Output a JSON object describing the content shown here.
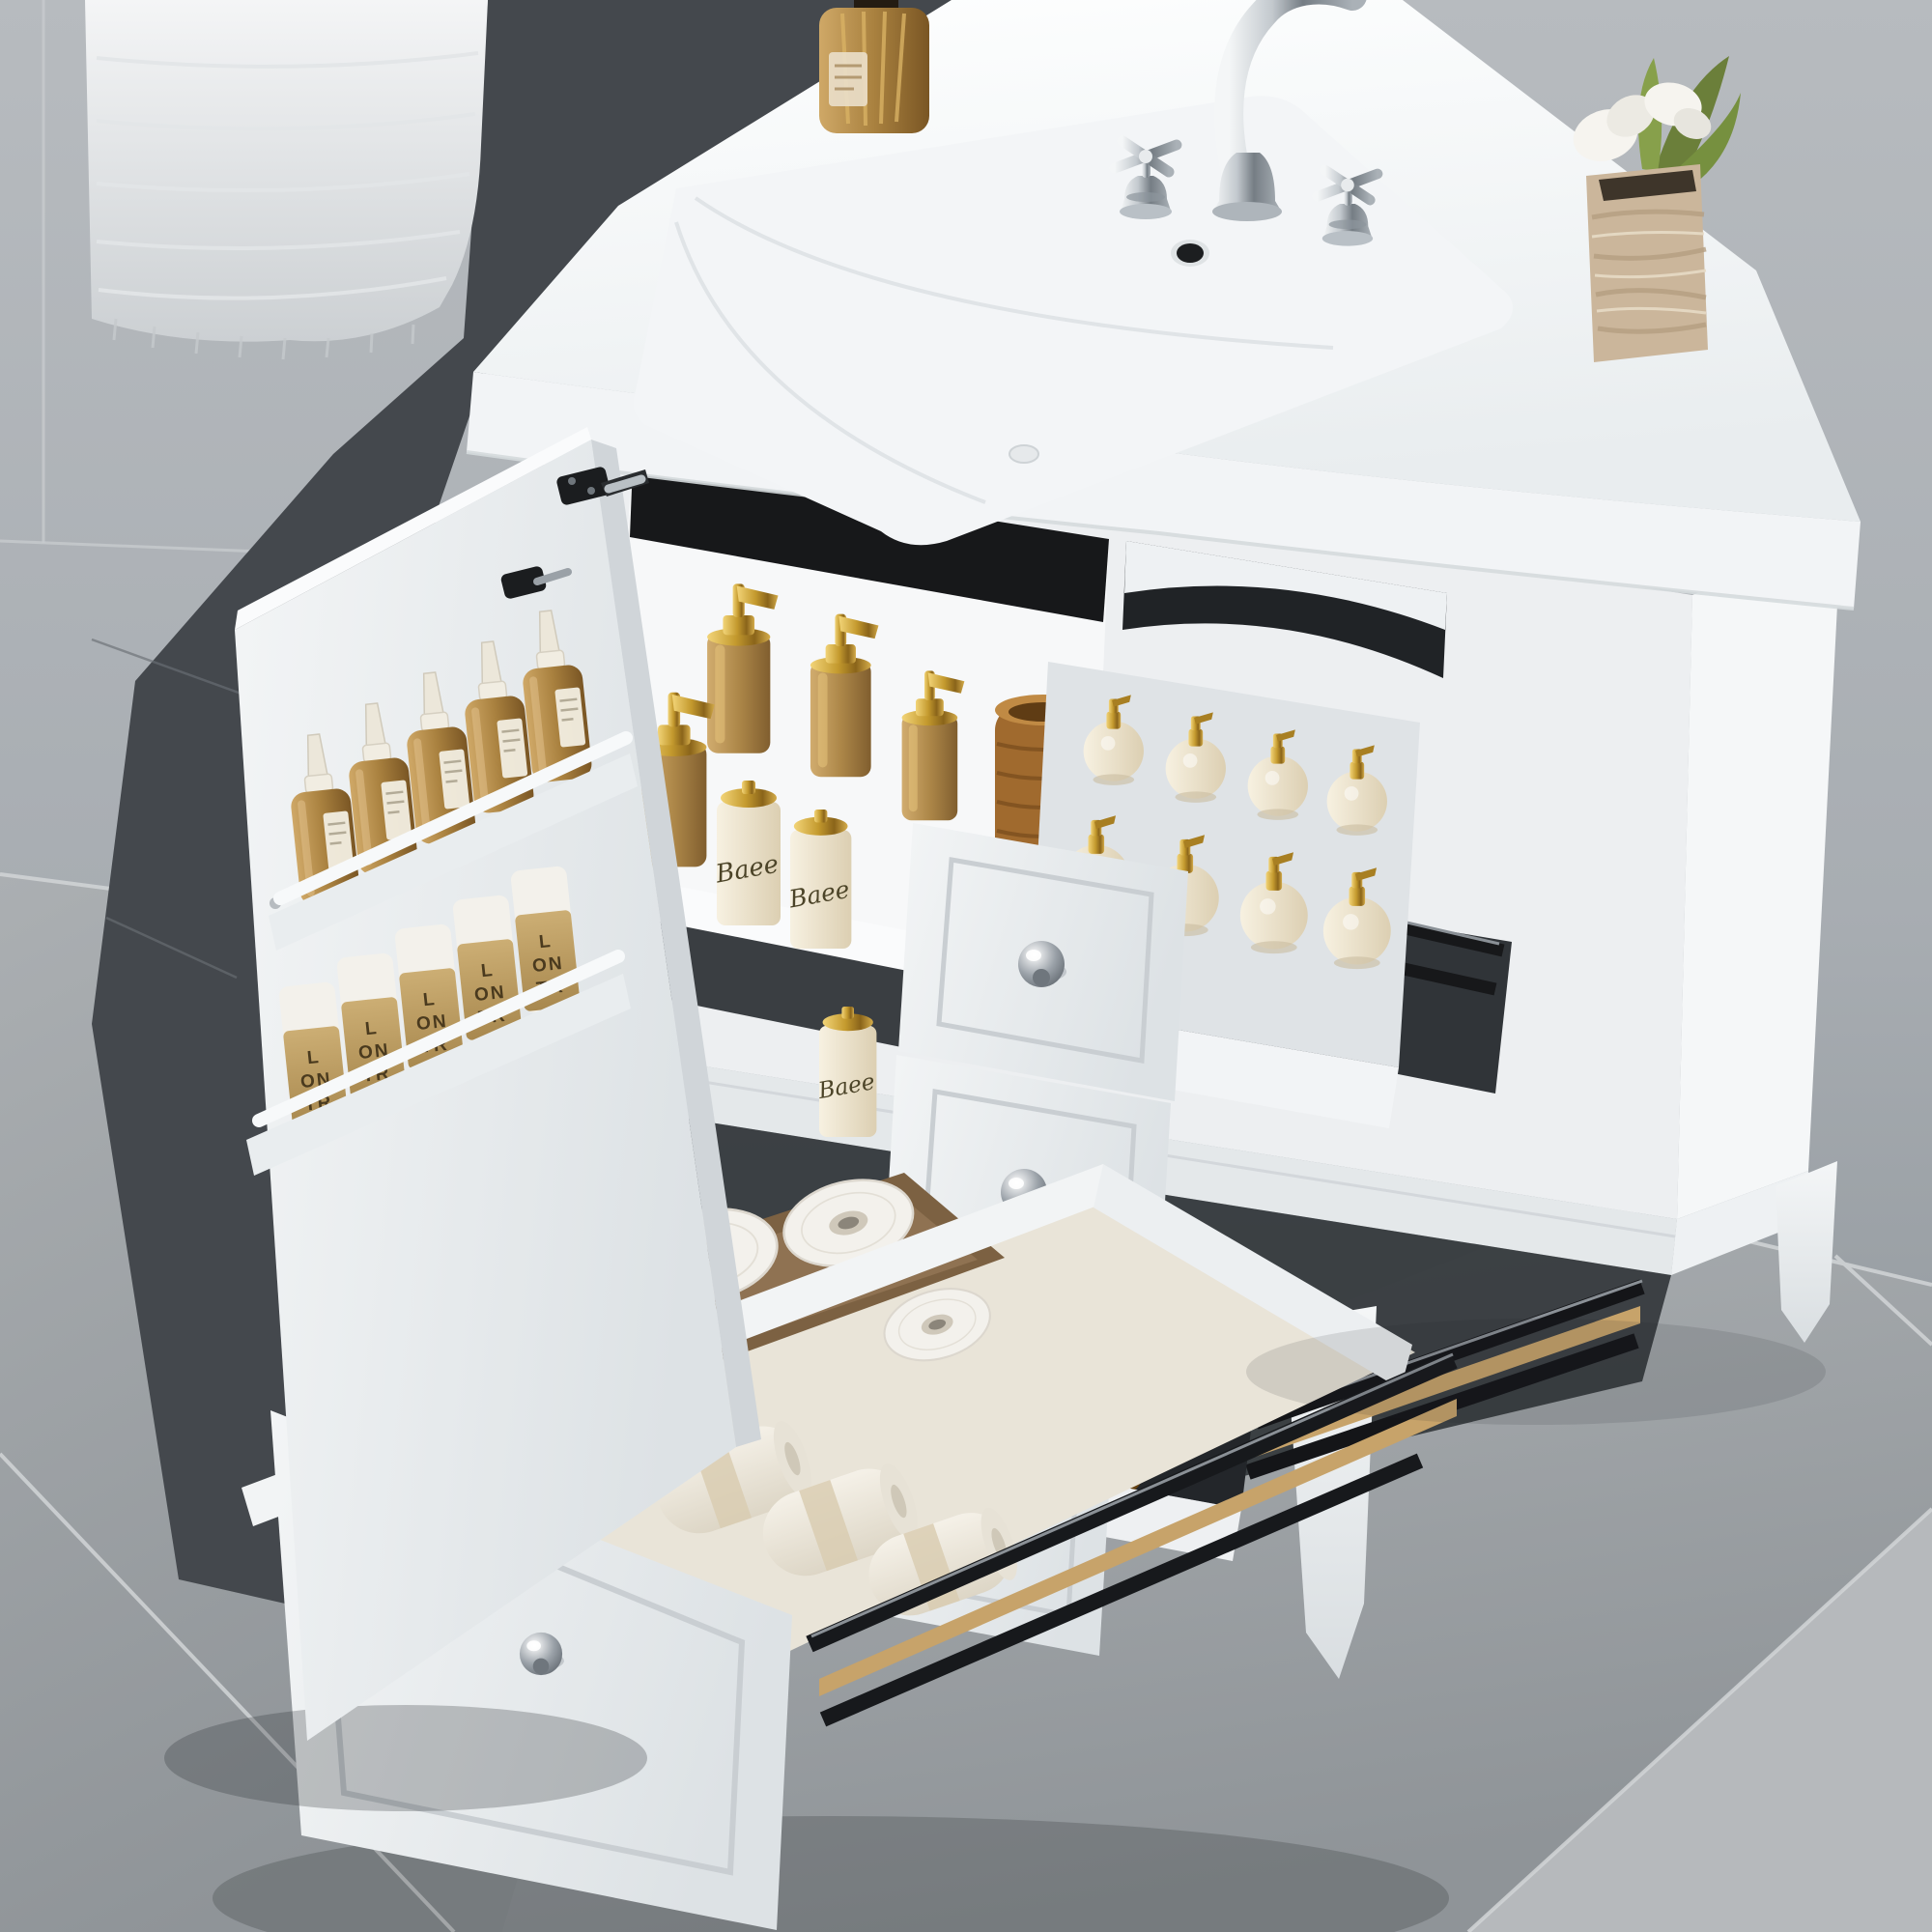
{
  "scene": {
    "subject": "White bathroom vanity with integrated ceramic sink, chrome widespread faucet, open left cabinet door with two-tier door rack of bottles, and three pulled-out drawers organized with toiletries",
    "setting": "gray tiled bathroom; white textured towel hanging at top left; gray tile floor",
    "decor": "amber reed-diffuser bottle on counter left, travertine stone vase with white flowers on counter right"
  },
  "labels": {
    "soap_bar": {
      "line1": "SOAP",
      "line2": "handmade"
    },
    "pump_bottle_script": "Baee",
    "kraft_sleeve": {
      "l1": "L",
      "l2": "ON",
      "l3": "TR"
    }
  },
  "palette": {
    "wall": "#b3b7bb",
    "wall_lower": "#9ea3a8",
    "wall_shadow": "#44484d",
    "floor": "#a6aaad",
    "floor_light_tile": "#b6b9bc",
    "grout": "#d2d5d7",
    "vanity_white": "#edeff1",
    "vanity_bright": "#f5f7f8",
    "ceramic": "#fbfcfd",
    "interior_dark": "#17181a",
    "chrome": "#c3c9ce",
    "gold": "#c49a2e",
    "amber_glass": "#a9813f",
    "cream": "#efe8d6",
    "kraft": "#bfa05e",
    "kraft_text": "#4a3a1e",
    "wood_tray": "#7c6142",
    "wicker": "#a06a2e"
  },
  "objects": [
    "hanging-towel",
    "countertop-sink",
    "faucet",
    "diffuser-bottle",
    "stone-vase-flowers",
    "open-cabinet-door",
    "door-rack-amber-dropper-bottles",
    "door-rack-kraft-cylinder-bottles",
    "shelf-gold-pump-dispensers",
    "wicker-basket",
    "baee-pump-bottles",
    "top-drawer-cream-pump-bottles",
    "middle-drawer-amber-bottles",
    "bottom-drawer-soap-bars",
    "bottom-drawer-towel-rolls",
    "bottom-drawer-toilet-paper",
    "drawer-slide-rails"
  ]
}
